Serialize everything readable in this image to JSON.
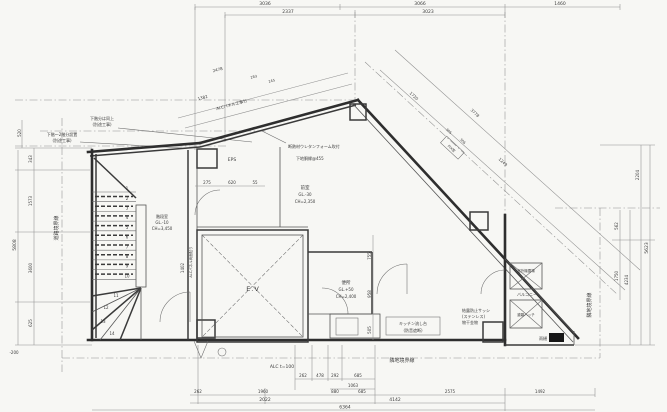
{
  "page": {
    "background": "#f7f7f4",
    "ink": "#2e2e2e",
    "dim_color": "#8f8f8f"
  },
  "dims": {
    "top1": [
      "3036",
      "3066",
      "1460"
    ],
    "top2": [
      "2337",
      "3023"
    ],
    "left_outer": "5808",
    "left_top": "520",
    "left_chain": [
      "343",
      "1573",
      "3600",
      "625"
    ],
    "left_offset": "-200",
    "right_chain": [
      "2204",
      "562",
      "1750"
    ],
    "right_mid": "4234",
    "right_outer": "5623",
    "bot1": [
      "262",
      "478",
      "292",
      "685"
    ],
    "bot2": "1063",
    "bot3": [
      "262",
      "1960",
      "880",
      "685",
      "2575",
      "1492"
    ],
    "bot4": [
      "2022",
      "4142"
    ],
    "bot_total": "6364",
    "diagL": [
      "2478",
      "283",
      "245",
      "1382"
    ],
    "diagR": [
      "1720",
      "3778",
      "305",
      "306",
      "1249"
    ],
    "in1": [
      "275",
      "620",
      "55"
    ],
    "in2": [
      "755",
      "958",
      "505"
    ],
    "in3": "1402"
  },
  "boundaries": {
    "road": "道路境界線",
    "site_right": "隣地境界線",
    "site_bottom": "隣地境界線"
  },
  "rooms": {
    "ev": "E.V",
    "eps": "EPS",
    "stair": [
      "階段室",
      "GL.-10",
      "CH=3,450"
    ],
    "toilet": [
      "便所",
      "GL.+50",
      "CH=2,400"
    ],
    "front": [
      "前室",
      "GL.-30",
      "CH=2,350"
    ],
    "balcony": "バルコニー",
    "unit_outdoor": "室外機置場",
    "hatch": "避難ハッチ"
  },
  "notes": {
    "callout1": [
      "下階〜2階分設置",
      "(別途工事)"
    ],
    "callout2": [
      "下階分は同上",
      "(別途工事)"
    ],
    "insulation": "断熱材ウレタンフォーム吹付",
    "furring": "下地胴縁@455",
    "alc_panel": "ALCパネル工事分",
    "alc_t100": "ALC t=100",
    "alc_wall": "ALCパネル両面貼り",
    "kitchen": [
      "キッチン流し台",
      "(防音遮断)"
    ],
    "sash": [
      "結露防止サッシ",
      "(ステンレス)",
      "物干金物"
    ],
    "gutter": "雨樋",
    "fix": "FIX窓"
  },
  "stairs": {
    "numbers": [
      "1",
      "2",
      "3",
      "4",
      "5",
      "6",
      "7",
      "8",
      "9",
      "10",
      "11",
      "12",
      "13",
      "14"
    ]
  }
}
